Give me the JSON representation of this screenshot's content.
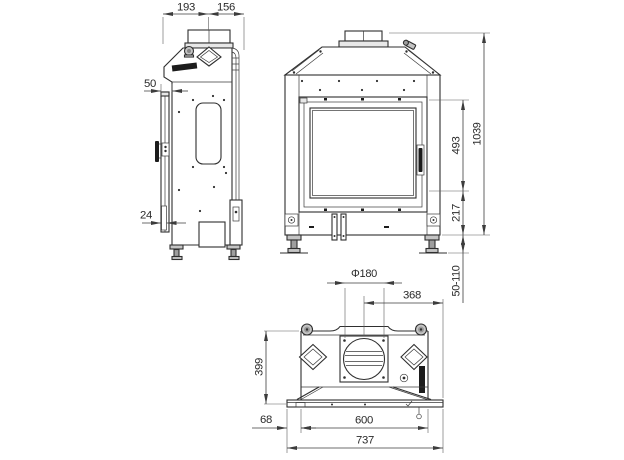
{
  "drawing": {
    "type": "technical-orthographic-views",
    "subject": "fireplace-insert",
    "dimensions": {
      "depth_front": "193",
      "depth_back": "156",
      "frame_offset": "50",
      "door_thickness": "24",
      "glass_height": "493",
      "total_height": "1039",
      "plinth_height": "217",
      "leg_range": "50-110",
      "flue_diameter": "Φ180",
      "flue_center_offset": "368",
      "top_depth": "399",
      "left_margin": "68",
      "body_width": "600",
      "overall_width": "737"
    },
    "colors": {
      "line": "#2f2f2f",
      "dimension_line": "#3c3c3c",
      "light_fill": "#e8e8e8",
      "metal_fill": "#c4c4c4",
      "badge": "#1c1c1c",
      "background": "#ffffff"
    }
  }
}
